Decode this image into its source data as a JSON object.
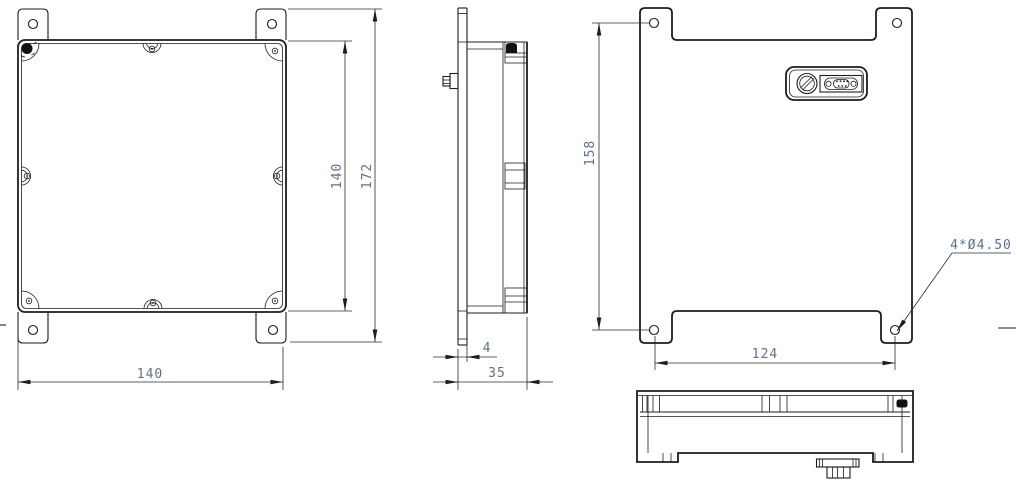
{
  "colors": {
    "line": "#1d1d1f",
    "dim_line": "#2b2b2b",
    "dim_text": "#5a7290",
    "background": "#ffffff"
  },
  "dimensions": {
    "front_height_inner": "140",
    "front_height_outer": "172",
    "front_width": "140",
    "side_flange_thickness": "4",
    "side_depth": "35",
    "back_hole_span_vertical": "158",
    "back_hole_span_horizontal": "124",
    "back_hole_callout": "4*Ø4.50"
  }
}
